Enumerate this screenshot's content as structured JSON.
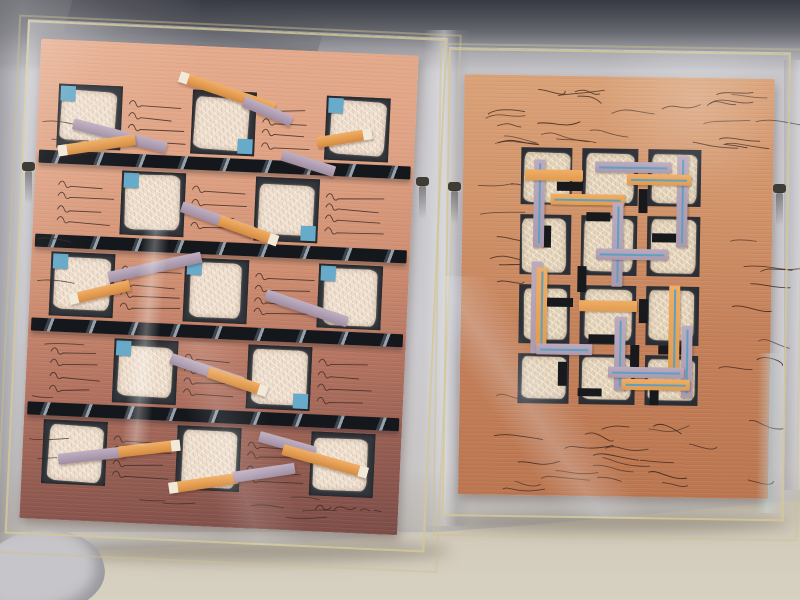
{
  "scene": {
    "alt_text": "Photograph of two abstract mixed-media paper collages in clear acrylic box frames, leaning against a gray fabric backdrop on a beige floor",
    "colors": {
      "backdrop": "#c8c7cc",
      "top_shadow": "#3a3d46",
      "floor": "#d3ccbc",
      "acrylic_edge": "#d3c898",
      "clip": "#3f3b35"
    },
    "clips": [
      {
        "x": 22,
        "y": 162
      },
      {
        "x": 416,
        "y": 177
      },
      {
        "x": 448,
        "y": 182
      },
      {
        "x": 773,
        "y": 184
      }
    ]
  },
  "left_artwork": {
    "frame": {
      "x": 28,
      "y": 20,
      "w": 420,
      "h": 514,
      "rot": 2.6
    },
    "paper": {
      "x": 14,
      "y": 18,
      "w": 378,
      "h": 480,
      "color_top": "#e7ad8e",
      "color_mid": "#cf8e71",
      "color_bottom": "#7c4c47"
    },
    "grid": {
      "cols_x": [
        20,
        87,
        154,
        221,
        288
      ],
      "rows_y": [
        44,
        128,
        212,
        296,
        380
      ],
      "cell": 64,
      "square_bg": "#33373c",
      "paper_fill": "#ecdccb",
      "bars_y": [
        111,
        195,
        279,
        363
      ],
      "bar_x": 3,
      "bar_w": 372,
      "bar_h": 13,
      "bar_color": "#14171c",
      "bar_streak": "#95a0ab",
      "scribble_color": "#3f2d24",
      "scribble_lines": 4
    },
    "blue_accent": {
      "color": "#68aac9",
      "size": 15,
      "placements": [
        [
          0,
          0,
          "tl"
        ],
        [
          0,
          2,
          "br"
        ],
        [
          0,
          4,
          "tl"
        ],
        [
          1,
          1,
          "tl"
        ],
        [
          1,
          3,
          "br"
        ],
        [
          2,
          0,
          "tl"
        ],
        [
          2,
          2,
          "tl"
        ],
        [
          2,
          4,
          "tl"
        ],
        [
          3,
          1,
          "tl"
        ],
        [
          3,
          3,
          "br"
        ],
        [
          4,
          1,
          "tl"
        ],
        [
          4,
          3,
          "br"
        ]
      ]
    },
    "strip_colors": {
      "orange": "#e6a158",
      "lavender": "#b2a1b4",
      "tip": "#f1e9d9"
    },
    "strips": [
      {
        "x": 140,
        "y": 26,
        "len": 100,
        "ang": 16,
        "color": "orange",
        "tip": "left"
      },
      {
        "x": 205,
        "y": 48,
        "len": 52,
        "ang": 20,
        "color": "lavender"
      },
      {
        "x": 36,
        "y": 78,
        "len": 96,
        "ang": 12,
        "color": "lavender"
      },
      {
        "x": 22,
        "y": 106,
        "len": 78,
        "ang": -11,
        "color": "orange",
        "tip": "left"
      },
      {
        "x": 280,
        "y": 86,
        "len": 56,
        "ang": -12,
        "color": "orange",
        "tip": "right"
      },
      {
        "x": 246,
        "y": 100,
        "len": 55,
        "ang": 15,
        "color": "lavender"
      },
      {
        "x": 148,
        "y": 156,
        "len": 76,
        "ang": 17,
        "color": "lavender"
      },
      {
        "x": 186,
        "y": 168,
        "len": 62,
        "ang": 17,
        "color": "orange",
        "tip": "right"
      },
      {
        "x": 78,
        "y": 230,
        "len": 95,
        "ang": -15,
        "color": "lavender"
      },
      {
        "x": 40,
        "y": 254,
        "len": 62,
        "ang": -16,
        "color": "orange",
        "tip": "left"
      },
      {
        "x": 236,
        "y": 240,
        "len": 86,
        "ang": 16,
        "color": "lavender"
      },
      {
        "x": 144,
        "y": 308,
        "len": 76,
        "ang": 16,
        "color": "lavender"
      },
      {
        "x": 182,
        "y": 320,
        "len": 62,
        "ang": 16,
        "color": "orange",
        "tip": "right"
      },
      {
        "x": 36,
        "y": 414,
        "len": 66,
        "ang": -9,
        "color": "lavender"
      },
      {
        "x": 96,
        "y": 404,
        "len": 62,
        "ang": -9,
        "color": "orange",
        "tip": "right"
      },
      {
        "x": 236,
        "y": 382,
        "len": 58,
        "ang": 13,
        "color": "lavender"
      },
      {
        "x": 260,
        "y": 394,
        "len": 88,
        "ang": 13,
        "color": "orange",
        "tip": "right"
      },
      {
        "x": 148,
        "y": 438,
        "len": 70,
        "ang": -11,
        "color": "orange",
        "tip": "left"
      },
      {
        "x": 212,
        "y": 424,
        "len": 62,
        "ang": -11,
        "color": "lavender"
      }
    ],
    "mark_regions": [
      {
        "x": 30,
        "y": 442,
        "w": 290,
        "h": 24,
        "count": 6
      },
      {
        "x": 4,
        "y": 60,
        "w": 14,
        "h": 360,
        "count": 8
      }
    ],
    "signature": {
      "x": 294,
      "y": 450,
      "present": true,
      "legible": false
    }
  },
  "right_artwork": {
    "frame": {
      "x": 449,
      "y": 48,
      "w": 342,
      "h": 468,
      "rot": 0.9
    },
    "paper": {
      "x": 16,
      "y": 26,
      "w": 310,
      "h": 420,
      "color_top": "#dba278",
      "color_bottom": "#bb7650"
    },
    "scribble_color": "#3a241c",
    "scribble_regions": [
      {
        "x": 8,
        "y": 6,
        "w": 290,
        "h": 62,
        "count": 26
      },
      {
        "x": 10,
        "y": 330,
        "w": 286,
        "h": 78,
        "count": 22
      },
      {
        "x": 6,
        "y": 80,
        "w": 44,
        "h": 244,
        "count": 8
      },
      {
        "x": 256,
        "y": 80,
        "w": 44,
        "h": 244,
        "count": 8
      }
    ],
    "motif": {
      "x": 58,
      "y": 72,
      "w": 180,
      "h": 256,
      "panel_bg": "#2b2e34",
      "block_fill": "#e2d2b8",
      "cols_x": [
        0,
        61,
        127
      ],
      "cols_w": [
        51,
        56,
        53
      ],
      "rows_y": [
        0,
        67,
        137,
        206
      ],
      "rows_h": [
        57,
        60,
        59,
        50
      ],
      "bar_thickness": 11,
      "bar_colors": {
        "lavender": "#b2a1b4",
        "orange": "#e8a75d",
        "pinstripe": "#5e9fc2"
      },
      "bars": [
        {
          "d": "v",
          "x": 13,
          "y": 12,
          "len": 88,
          "c": "lav",
          "pin": true
        },
        {
          "d": "h",
          "x": 4,
          "y": 22,
          "len": 58,
          "c": "org",
          "pin": false
        },
        {
          "d": "h",
          "x": 74,
          "y": 13,
          "len": 76,
          "c": "lav",
          "pin": true
        },
        {
          "d": "v",
          "x": 156,
          "y": 6,
          "len": 92,
          "c": "lav",
          "pin": true
        },
        {
          "d": "h",
          "x": 106,
          "y": 25,
          "len": 64,
          "c": "org",
          "pin": true
        },
        {
          "d": "h",
          "x": 30,
          "y": 46,
          "len": 74,
          "c": "org",
          "pin": true
        },
        {
          "d": "v",
          "x": 92,
          "y": 54,
          "len": 84,
          "c": "lav",
          "pin": true
        },
        {
          "d": "h",
          "x": 76,
          "y": 100,
          "len": 72,
          "c": "lav",
          "pin": true
        },
        {
          "d": "v",
          "x": 12,
          "y": 114,
          "len": 92,
          "c": "lav",
          "pin": false
        },
        {
          "d": "v",
          "x": 17,
          "y": 120,
          "len": 80,
          "c": "org",
          "pin": true
        },
        {
          "d": "v",
          "x": 150,
          "y": 136,
          "len": 86,
          "c": "org",
          "pin": true
        },
        {
          "d": "v",
          "x": 163,
          "y": 176,
          "len": 72,
          "c": "lav",
          "pin": true
        },
        {
          "d": "h",
          "x": 60,
          "y": 152,
          "len": 58,
          "c": "org",
          "pin": false
        },
        {
          "d": "v",
          "x": 96,
          "y": 168,
          "len": 74,
          "c": "lav",
          "pin": true
        },
        {
          "d": "h",
          "x": 18,
          "y": 196,
          "len": 56,
          "c": "lav",
          "pin": true
        },
        {
          "d": "h",
          "x": 90,
          "y": 218,
          "len": 76,
          "c": "lav",
          "pin": true
        },
        {
          "d": "h",
          "x": 104,
          "y": 230,
          "len": 68,
          "c": "org",
          "pin": true
        }
      ],
      "black_rects": [
        {
          "x": 36,
          "y": 34,
          "w": 26,
          "h": 9
        },
        {
          "x": 118,
          "y": 40,
          "w": 9,
          "h": 24
        },
        {
          "x": 66,
          "y": 64,
          "w": 24,
          "h": 9
        },
        {
          "x": 22,
          "y": 78,
          "w": 9,
          "h": 22
        },
        {
          "x": 132,
          "y": 84,
          "w": 26,
          "h": 9
        },
        {
          "x": 58,
          "y": 118,
          "w": 9,
          "h": 26
        },
        {
          "x": 28,
          "y": 150,
          "w": 26,
          "h": 9
        },
        {
          "x": 120,
          "y": 150,
          "w": 9,
          "h": 24
        },
        {
          "x": 70,
          "y": 186,
          "w": 26,
          "h": 9
        },
        {
          "x": 140,
          "y": 196,
          "w": 24,
          "h": 9
        },
        {
          "x": 40,
          "y": 214,
          "w": 9,
          "h": 24
        },
        {
          "x": 112,
          "y": 196,
          "w": 9,
          "h": 22
        },
        {
          "x": 60,
          "y": 240,
          "w": 24,
          "h": 8
        },
        {
          "x": 132,
          "y": 238,
          "w": 9,
          "h": 18
        }
      ]
    }
  }
}
